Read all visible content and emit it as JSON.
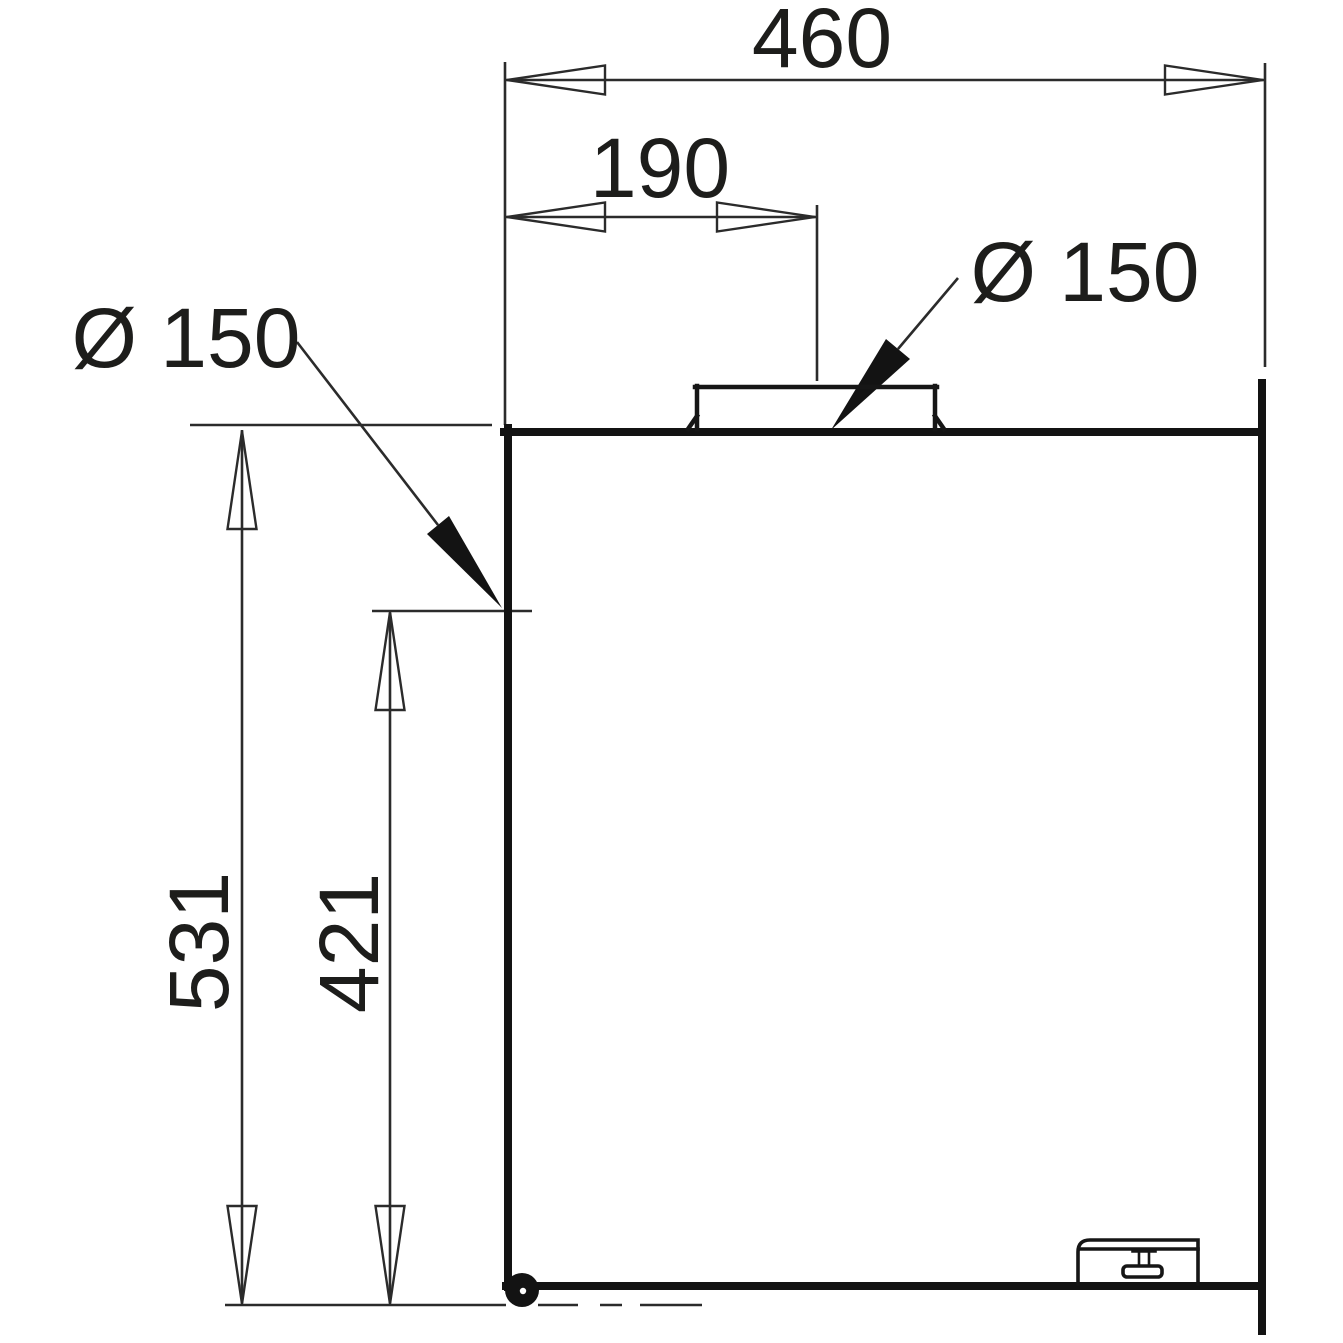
{
  "colors": {
    "background": "#ffffff",
    "thin_line": "#2b2b2b",
    "outline": "#131313",
    "text": "#1d1d1b"
  },
  "dimensions": [
    {
      "id": "overall-width",
      "label": "460"
    },
    {
      "id": "collar-offset",
      "label": "190"
    },
    {
      "id": "diameter-top",
      "label": "Ø 150"
    },
    {
      "id": "diameter-side",
      "label": "Ø 150"
    },
    {
      "id": "height-total",
      "label": "531"
    },
    {
      "id": "height-partial",
      "label": "421"
    }
  ]
}
